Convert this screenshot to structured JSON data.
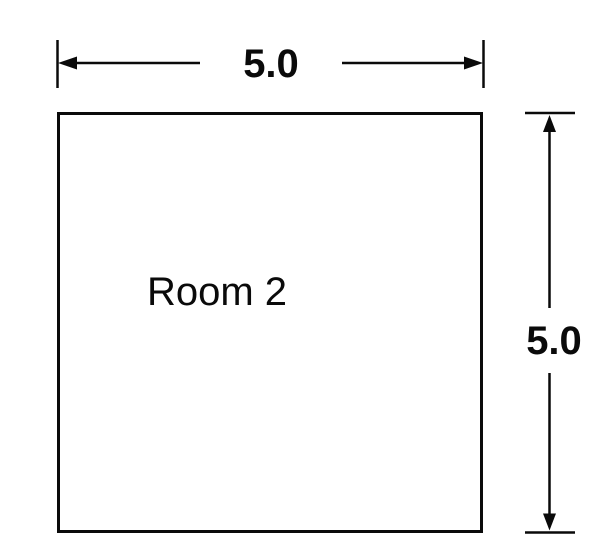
{
  "diagram": {
    "title": "room-plan",
    "background_color": "#ffffff",
    "line_color": "#0a0a0a",
    "room": {
      "label": "Room 2",
      "shape": "square"
    },
    "dimensions": {
      "width": {
        "label": "5.0"
      },
      "height": {
        "label": "5.0"
      }
    }
  }
}
